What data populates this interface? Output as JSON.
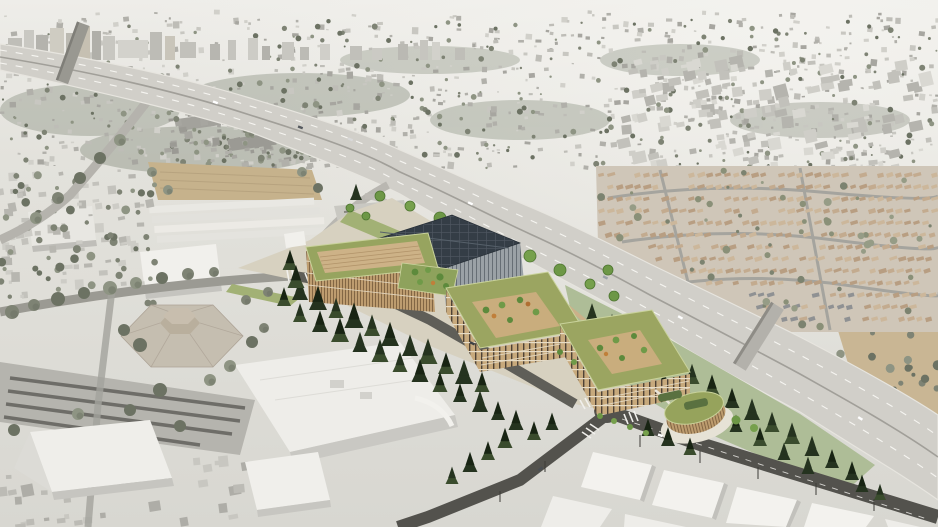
{
  "meta": {
    "description": "Aerial architectural rendering of a proposed mass-timber mixed-use campus with green roofs and a dark solar roof, set in color beside a curving freeway interchange while the surrounding city, freeway and foreground warehouses are desaturated gray",
    "canvas": {
      "width": 938,
      "height": 527
    }
  },
  "palette": {
    "hazeTop": "#edece8",
    "hazeMid": "#e2e1db",
    "ground": "#d9d8d2",
    "block1": "#c8c7c1",
    "block2": "#bebdb7",
    "block3": "#d1d0ca",
    "block4": "#b1b0aa",
    "block5": "#a7a6a0",
    "treeGray": "#7e8374",
    "treeGrayDark": "#6c7263",
    "treeMass": "#9aa092",
    "freeway": "#d1cfc9",
    "freewayEdge": "#e7e5df",
    "laneWhite": "#f6f5f1",
    "median": "#a19f99",
    "roadLight": "#a9a8a2",
    "roadMid": "#8f8e88",
    "asphalt": "#53524d",
    "asphalt2": "#605f5a",
    "dirt": "#c6b28c",
    "hill": "#c9b694",
    "house1": "#c3ab8f",
    "house2": "#b89e82",
    "house3": "#ccb79b",
    "houseDark": "#8f9193",
    "white": "#f1f0ec",
    "whiteSide": "#c5c4bf",
    "shade": "#b3b2ad",
    "hexRoof": "#c5beb0",
    "hexDrum": "#b9af9d",
    "lawn": "#a2b175",
    "lawnPale": "#aebd97",
    "buffer": "#9aa96e",
    "conifer": "#25331f",
    "conifer2": "#3a4c2d",
    "treeBright": "#6d9746",
    "treeBrightDark": "#4d7530",
    "wood": "#bd9c6f",
    "woodDark": "#7c603f",
    "woodLight": "#d2b88c",
    "trim": "#eadfc9",
    "windowDark": "#4e4236",
    "greenRoof": "#9ba561",
    "greenRoofLight": "#c9d29b",
    "solar": "#343d46",
    "solarLine": "#4d5660",
    "court": "#c9ad7d",
    "roofCourt": "#cdb287",
    "roofCourtLine": "#b2946a",
    "orangeTree": "#c07f3a",
    "plaza": "#d7d1c0",
    "path": "#eae6da",
    "fascia": "#edebe4",
    "facadeGray": "#9aa1a6",
    "facadeGrayLine": "#666e75"
  },
  "scene": {
    "landmarks": [
      {
        "id": "downtown-skyline",
        "label": "distant downtown towers",
        "colorKey": "block2"
      },
      {
        "id": "freeway",
        "label": "curving multi-lane freeway",
        "colorKey": "freeway"
      },
      {
        "id": "residential-park",
        "label": "mobile-home park beyond freeway",
        "colorKey": "house1"
      },
      {
        "id": "dirt-lot",
        "label": "vacant dirt parcel",
        "colorKey": "dirt"
      },
      {
        "id": "industrial-sheds",
        "label": "white industrial sheds",
        "colorKey": "white"
      },
      {
        "id": "office-building",
        "label": "timber office building with tan roof court",
        "colorKey": "wood"
      },
      {
        "id": "event-center",
        "label": "event hall with dark solar roof",
        "colorKey": "solar"
      },
      {
        "id": "residential-block-1",
        "label": "green-roof residential courtyard block",
        "colorKey": "greenRoof"
      },
      {
        "id": "residential-block-2",
        "label": "second green-roof courtyard block",
        "colorKey": "greenRoof"
      },
      {
        "id": "corner-pavilion",
        "label": "oval timber corner pavilion",
        "colorKey": "greenRoof"
      },
      {
        "id": "hexagonal-hall",
        "label": "existing hexagonal hall",
        "colorKey": "hexRoof"
      },
      {
        "id": "white-slab-building",
        "label": "existing flat white building",
        "colorKey": "white"
      },
      {
        "id": "foreground-warehouses",
        "label": "white warehouse grid in foreground",
        "colorKey": "white"
      },
      {
        "id": "green-buffer",
        "label": "landscaped conifer buffer along freeway",
        "colorKey": "buffer"
      }
    ]
  }
}
